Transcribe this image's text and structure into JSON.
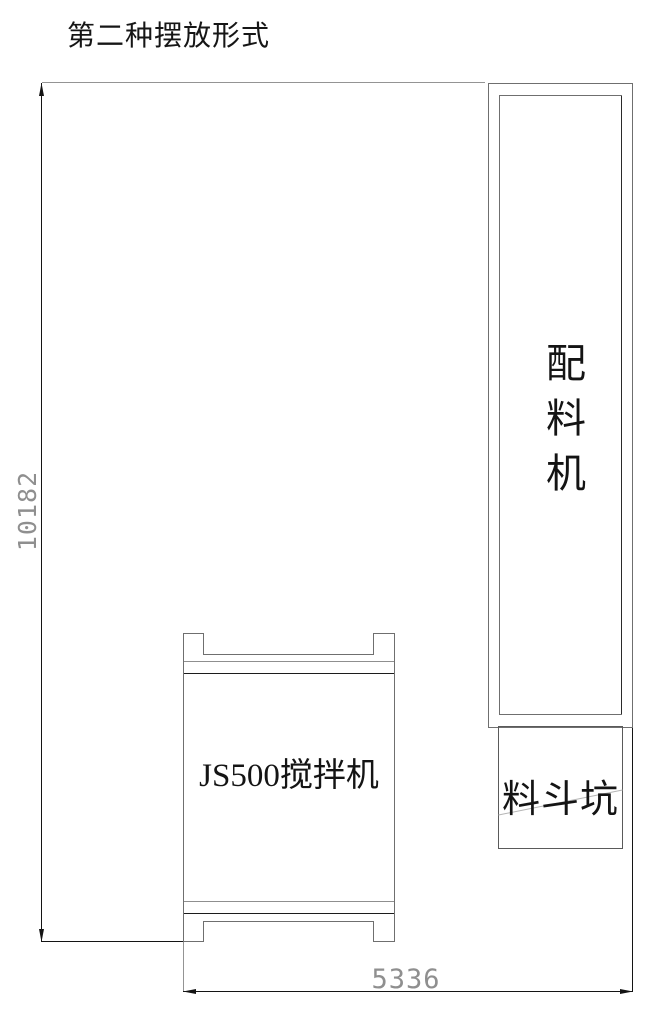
{
  "title": "第二种摆放形式",
  "labels": {
    "batching_machine": "配料机",
    "mixer": "JS500搅拌机",
    "hopper_pit": "料斗坑"
  },
  "dimensions": {
    "height": "10182",
    "width": "5336"
  },
  "colors": {
    "background": "#ffffff",
    "machine_outline_gray": "#6f6f6f",
    "extension_line_gray": "#949494",
    "dimension_line_black": "#141414",
    "dimension_text_gray": "#8f8f8f",
    "label_text": "#141414"
  }
}
